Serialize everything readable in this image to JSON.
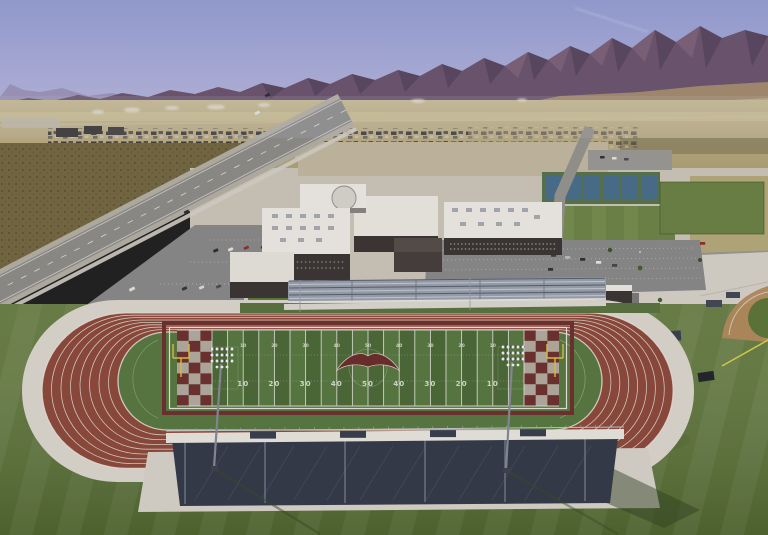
{
  "scene": {
    "description": "Aerial drone photo of a desert high school campus with an 8-lane running track and football stadium, purple mountain range and dry valley behind",
    "field": {
      "yard_numbers_near": [
        "10",
        "20",
        "30",
        "40",
        "50",
        "40",
        "30",
        "20",
        "10"
      ],
      "yard_numbers_far": [
        "10",
        "20",
        "30",
        "40",
        "50",
        "40",
        "30",
        "20",
        "10"
      ],
      "lane_count": "8"
    },
    "colors": {
      "sky_top": "#96a0d4",
      "sky_horizon": "#c9c8e4",
      "mountain": "#6d5670",
      "mountain_shadow": "#4e3d55",
      "foothill": "#aa9470",
      "valley": "#c2b489",
      "scrub": "#746a42",
      "road": "#8f8e8a",
      "concrete": "#d8d4cb",
      "roof": "#efede7",
      "wall": "#3b3634",
      "track": "#8d4a3c",
      "apron": "#dcd8cf",
      "lane_line": "#eae5da",
      "infield": "#587a41",
      "turf_dark": "#4c6a37",
      "turf_light": "#587a41",
      "yard_line": "#e8e8e0",
      "yard_number": "#e4e4da",
      "endzone_maroon": "#6e3230",
      "endzone_light": "#b4aba0",
      "logo": "#6b2e2c",
      "goal_post": "#dec43f",
      "grandstand": "#343b49",
      "walkway": "#e9e7e0",
      "bleacher": "#99a2ad",
      "grass": "#5d7637"
    }
  }
}
